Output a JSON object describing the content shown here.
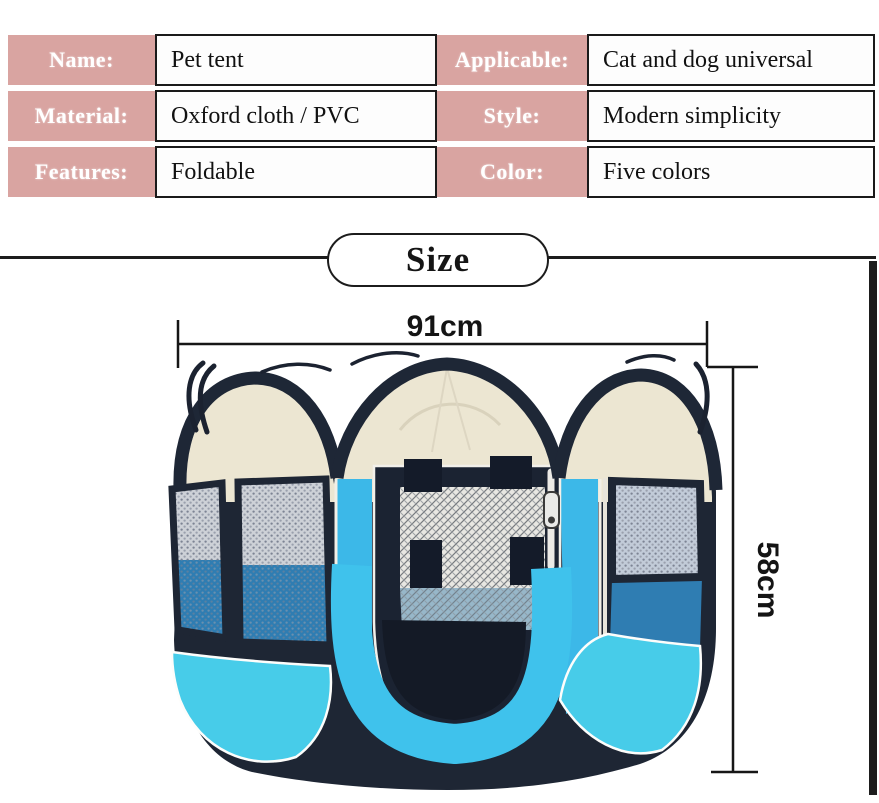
{
  "spec_table": {
    "rows_left": [
      {
        "label": "Name:",
        "value": "Pet tent"
      },
      {
        "label": "Material:",
        "value": "Oxford cloth / PVC"
      },
      {
        "label": "Features:",
        "value": "Foldable"
      }
    ],
    "rows_right": [
      {
        "label": "Applicable:",
        "value": "Cat and dog universal"
      },
      {
        "label": "Style:",
        "value": "Modern simplicity"
      },
      {
        "label": "Color:",
        "value": "Five colors"
      }
    ],
    "label_bg_color": "#d9a4a1"
  },
  "size_section": {
    "heading": "Size",
    "width_label": "91cm",
    "height_label": "58cm"
  },
  "illustration": {
    "subject": "foldable octagonal pet tent playpen, front view",
    "colors": {
      "roof_cream": "#ece6d2",
      "frame_navy": "#1e2634",
      "mesh_grey": "#ccd1d8",
      "door_blue": "#3fc2ec",
      "corner_cyan": "#47cce9",
      "floor_blue": "#2f7db2"
    }
  }
}
